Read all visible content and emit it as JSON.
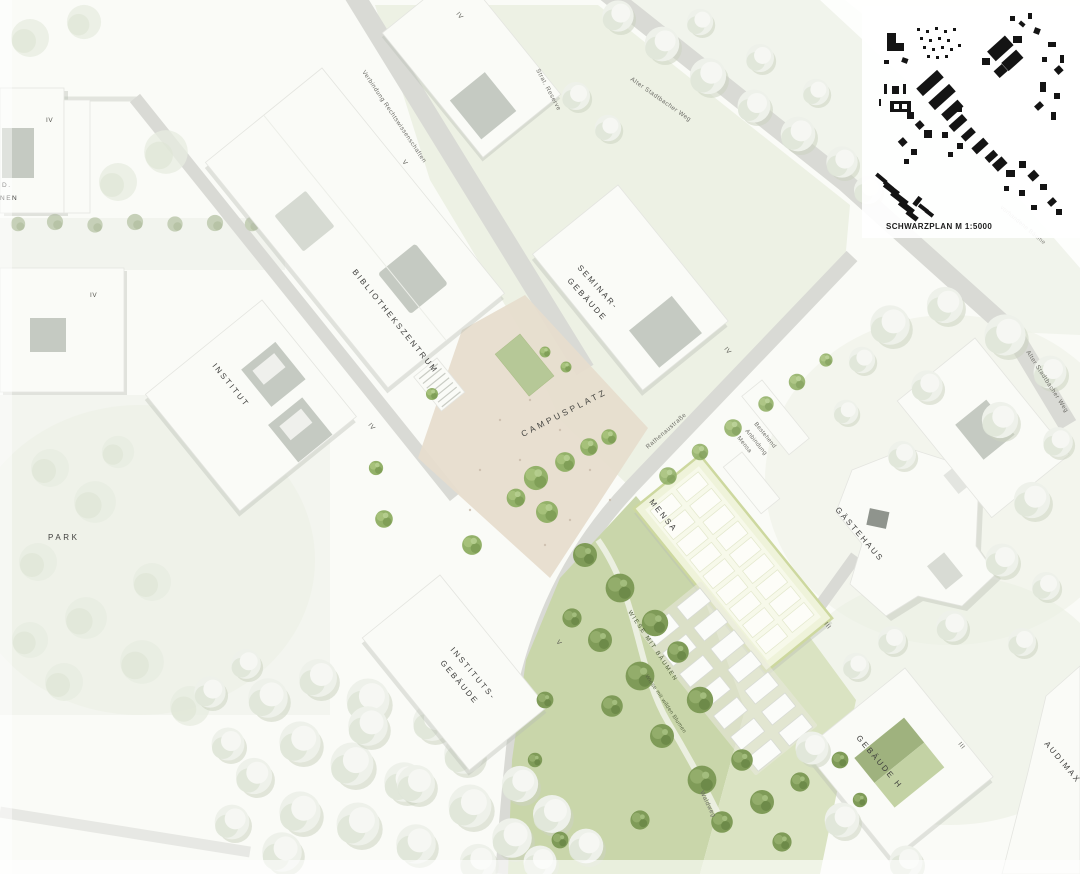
{
  "legend": {
    "schwarzplan_label": "SCHWARZPLAN M 1:5000"
  },
  "buildings": {
    "bibliothekszentrum": "BIBLIOTHEKSZENTRUM",
    "seminar_line1": "SEMINAR-",
    "seminar_line2": "GEBÄUDE",
    "institut": "INSTITUT",
    "instituts_line1": "INSTITUTS-",
    "instituts_line2": "GEBÄUDE",
    "mensa": "MENSA",
    "gaestehaus": "GÄSTEHAUS",
    "gebaeude_h": "GEBÄUDE H",
    "audimax": "AUDIMAX",
    "wohnen_cut_line1": "D.",
    "wohnen_cut_line2": "NEN"
  },
  "places": {
    "campusplatz": "CAMPUSPLATZ",
    "park": "PARK",
    "wiese_mit_baeumen": "WIESE MIT BÄUMEN",
    "wiese_mit_wilden_blumen": "Wiese mit wilden Blumen"
  },
  "streets": {
    "verbindung_rechtswissenschaften": "Verbindung Rechtswissenschaften",
    "alter_stadtbacher_weg_nord": "Alter Stadtbacher Weg",
    "alter_stadtbacher_weg_ost": "Alter Stadtbacher Weg",
    "rathenaustrasse": "Rathenaustraße",
    "strat_reserve": "Strat. Reserve",
    "waldweg": "Waldweg",
    "vorhandene_baeume": "vorhandene Bäume"
  },
  "annotations": {
    "anbindung_line1": "Bestehend",
    "anbindung_line2": "Anbindung",
    "anbindung_line3": "Mensa"
  },
  "floors": {
    "wohnen_nord": "IV",
    "wohnen_sued": "IV",
    "verfuegung": "IV",
    "bibliothek": "V",
    "institut": "IV",
    "seminar": "IV",
    "institutsgebaeude": "V",
    "mensa": "III",
    "gebaeude_h": "III"
  },
  "colors": {
    "bg": "#fafbf7",
    "bld": "#fafbf7",
    "bld_edge": "#e4e5e0",
    "court": "#c5cac2",
    "shadow": "#b9bdb5",
    "road": "#d9dad5",
    "lawn": "#eaefe1",
    "lawn_light": "#eff2e8",
    "meadow": "#c9d6aa",
    "meadow_light": "#dae3c2",
    "plaza": "#e7ddcd",
    "mensa_roof": "#eff3da",
    "tree_green": "#93b169",
    "tree_dark": "#7f9b58",
    "black_plan": "#141414",
    "label_dark": "#3e3e3c",
    "label_mid": "#6e6e68"
  }
}
